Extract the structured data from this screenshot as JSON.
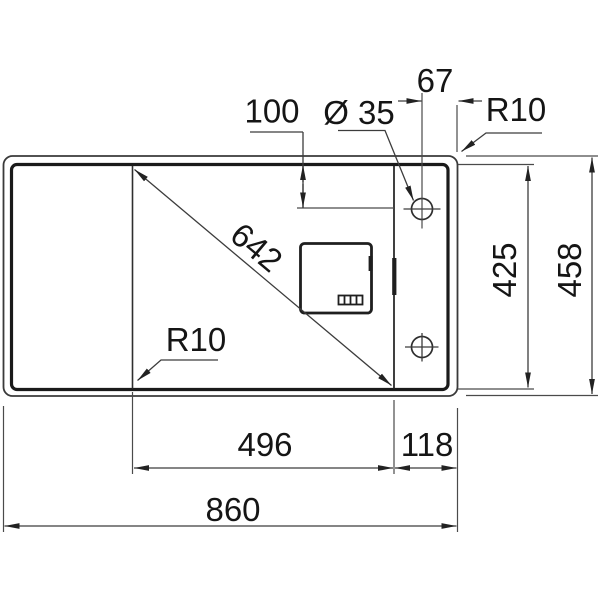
{
  "drawing": {
    "type": "technical-dimension-drawing",
    "subject": "kitchen-sink-top-view",
    "annotations": {
      "tap_offset_from_edge": "67",
      "tap_setback_from_top": "100",
      "tap_hole_diameter": "Ø 35",
      "corner_radius_top": "R10",
      "bowl_diagonal": "642",
      "bowl_depth": "425",
      "overall_depth": "458",
      "corner_radius_bottom": "R10",
      "bowl_width": "496",
      "ledge_width": "118",
      "overall_width": "860"
    },
    "colors": {
      "background": "#ffffff",
      "line": "#2e2e2e",
      "text": "#151515"
    }
  }
}
